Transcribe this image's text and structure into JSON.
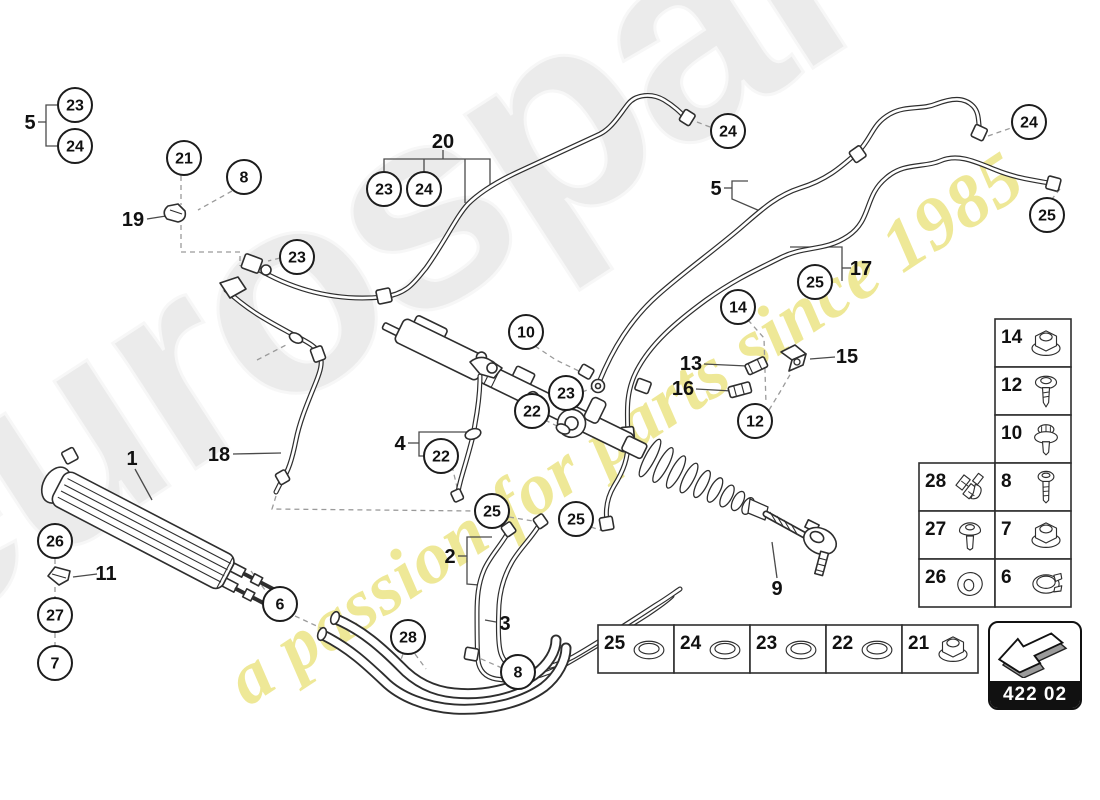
{
  "watermark": {
    "brand": "eurospares",
    "tagline": "a passion for parts since 1985"
  },
  "badge": {
    "code": "422 02"
  },
  "callouts": [
    {
      "n": "23",
      "x": 75,
      "y": 105
    },
    {
      "n": "24",
      "x": 75,
      "y": 146
    },
    {
      "n": "21",
      "x": 184,
      "y": 158
    },
    {
      "n": "8",
      "x": 244,
      "y": 177
    },
    {
      "n": "23",
      "x": 297,
      "y": 257
    },
    {
      "n": "23",
      "x": 384,
      "y": 189
    },
    {
      "n": "24",
      "x": 424,
      "y": 189
    },
    {
      "n": "24",
      "x": 728,
      "y": 131
    },
    {
      "n": "24",
      "x": 1029,
      "y": 122
    },
    {
      "n": "25",
      "x": 1047,
      "y": 215
    },
    {
      "n": "25",
      "x": 815,
      "y": 282
    },
    {
      "n": "14",
      "x": 738,
      "y": 307
    },
    {
      "n": "12",
      "x": 755,
      "y": 421
    },
    {
      "n": "10",
      "x": 526,
      "y": 332
    },
    {
      "n": "23",
      "x": 566,
      "y": 393
    },
    {
      "n": "22",
      "x": 532,
      "y": 411
    },
    {
      "n": "22",
      "x": 441,
      "y": 456
    },
    {
      "n": "26",
      "x": 55,
      "y": 541
    },
    {
      "n": "27",
      "x": 55,
      "y": 615
    },
    {
      "n": "7",
      "x": 55,
      "y": 663
    },
    {
      "n": "6",
      "x": 280,
      "y": 604
    },
    {
      "n": "25",
      "x": 492,
      "y": 511
    },
    {
      "n": "25",
      "x": 576,
      "y": 519
    },
    {
      "n": "28",
      "x": 408,
      "y": 637
    },
    {
      "n": "8",
      "x": 518,
      "y": 672
    }
  ],
  "labels": [
    {
      "n": "5",
      "x": 30,
      "y": 122
    },
    {
      "n": "19",
      "x": 133,
      "y": 219
    },
    {
      "n": "20",
      "x": 443,
      "y": 141
    },
    {
      "n": "5",
      "x": 716,
      "y": 188
    },
    {
      "n": "17",
      "x": 861,
      "y": 268
    },
    {
      "n": "15",
      "x": 847,
      "y": 356
    },
    {
      "n": "13",
      "x": 691,
      "y": 363
    },
    {
      "n": "16",
      "x": 683,
      "y": 388
    },
    {
      "n": "4",
      "x": 400,
      "y": 443
    },
    {
      "n": "18",
      "x": 219,
      "y": 454
    },
    {
      "n": "1",
      "x": 132,
      "y": 458
    },
    {
      "n": "11",
      "x": 106,
      "y": 573
    },
    {
      "n": "2",
      "x": 450,
      "y": 556
    },
    {
      "n": "3",
      "x": 505,
      "y": 623
    },
    {
      "n": "9",
      "x": 777,
      "y": 588
    }
  ],
  "fastener_table": {
    "x": 919,
    "y": 319,
    "col_w": 76,
    "row_h": 48,
    "cells": [
      {
        "n": "14",
        "icon": "flange-nut",
        "col": 1,
        "row": 0
      },
      {
        "n": "12",
        "icon": "screw",
        "col": 1,
        "row": 1
      },
      {
        "n": "10",
        "icon": "flange-bolt",
        "col": 1,
        "row": 2
      },
      {
        "n": "28",
        "icon": "clip",
        "col": 0,
        "row": 3
      },
      {
        "n": "8",
        "icon": "bolt",
        "col": 1,
        "row": 3
      },
      {
        "n": "27",
        "icon": "dome-bolt",
        "col": 0,
        "row": 4
      },
      {
        "n": "7",
        "icon": "flange-nut",
        "col": 1,
        "row": 4
      },
      {
        "n": "26",
        "icon": "washer",
        "col": 0,
        "row": 5
      },
      {
        "n": "6",
        "icon": "clamp",
        "col": 1,
        "row": 5
      }
    ]
  },
  "seal_table": {
    "x": 598,
    "y": 625,
    "col_w": 76,
    "row_h": 48,
    "cells": [
      {
        "n": "25",
        "icon": "oring"
      },
      {
        "n": "24",
        "icon": "oring"
      },
      {
        "n": "23",
        "icon": "oring"
      },
      {
        "n": "22",
        "icon": "oring"
      },
      {
        "n": "21",
        "icon": "flange-nut"
      }
    ]
  }
}
